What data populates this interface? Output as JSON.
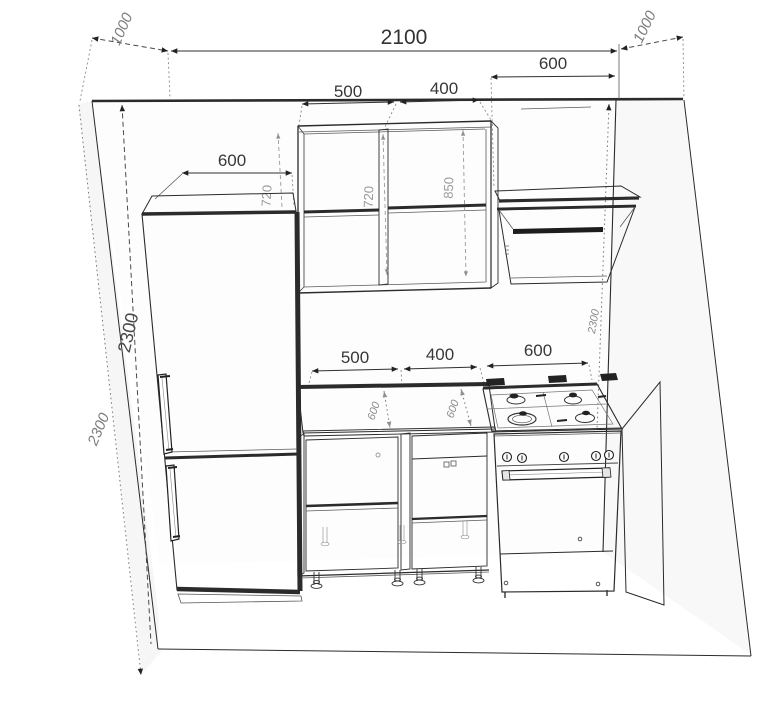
{
  "drawing": {
    "title": "kitchen-elevation-drawing",
    "line_color": "#2b2b2b",
    "dim_text_color": "#3a3a3a",
    "faint_text_color": "#9a9a9a"
  },
  "dims": {
    "room_width": "2100",
    "room_depth_left": "1000",
    "room_depth_right": "1000",
    "room_height_inner": "2300",
    "room_height_outer": "2300",
    "room_height_right": "2300",
    "fridge_width": "600",
    "hood_width": "600",
    "wall_cabinet_left_width": "500",
    "wall_cabinet_right_width": "400",
    "wall_cabinet_height": "720",
    "wall_cabinet_inner_height": "720",
    "worktop_to_cabinet": "850",
    "base_cabinet_left_width": "500",
    "base_cabinet_right_width": "400",
    "stove_width": "600",
    "counter_depth_left": "600",
    "counter_depth_right": "600"
  }
}
